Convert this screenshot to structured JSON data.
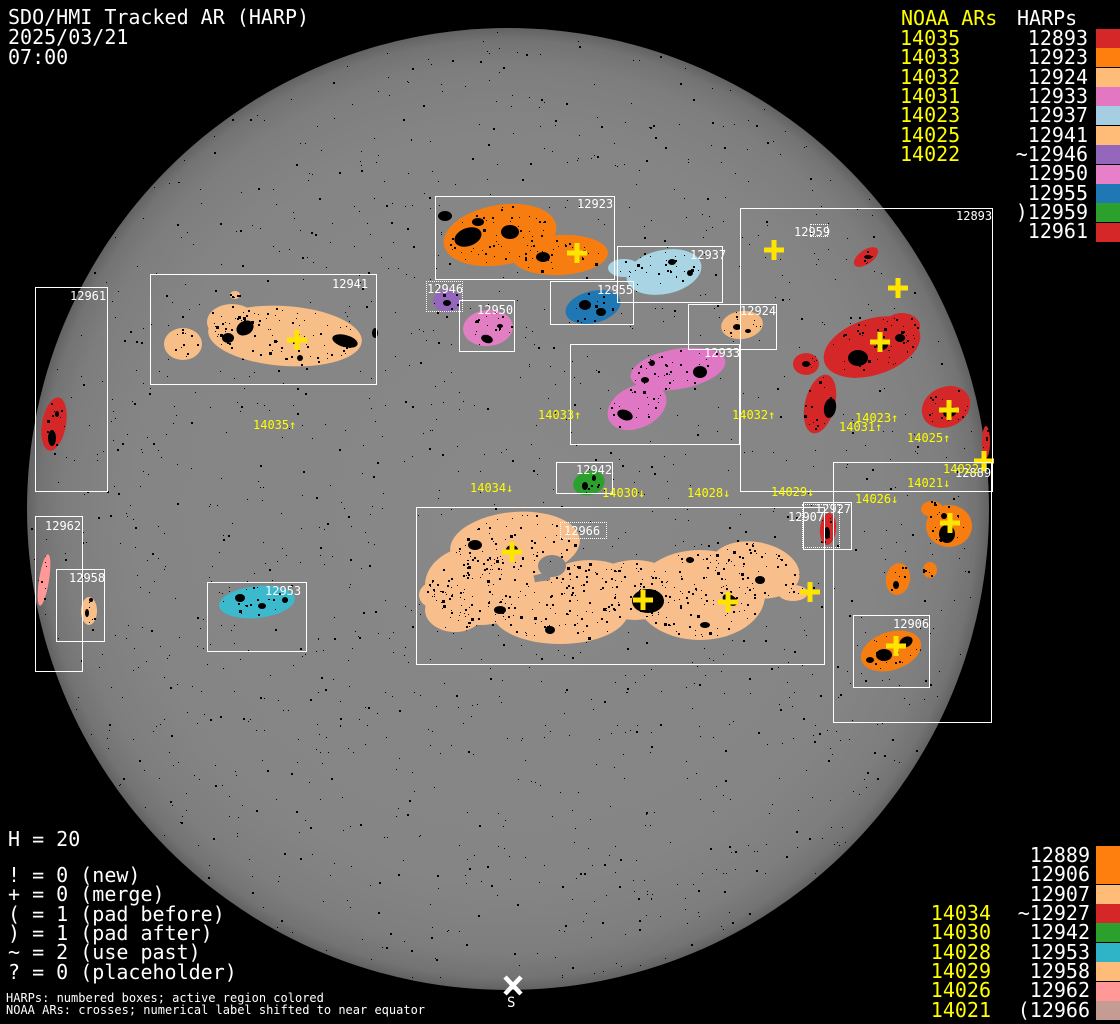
{
  "title": {
    "line1": "SDO/HMI Tracked AR (HARP)",
    "line2": "2025/03/21",
    "line3": "07:00"
  },
  "colors": {
    "background": "#000000",
    "disk_gray": "#858585",
    "box_line": "#ffffff",
    "harp_text": "#ffffff",
    "noaa_text": "#ffff00",
    "cross": "#ffe400",
    "speckle": "#000000",
    "south_marker": "#ffffff"
  },
  "top_legend": {
    "noaa_header": "NOAA ARs",
    "harp_header": "HARPs",
    "noaa_rows": [
      "14035",
      "14033",
      "14032",
      "14031",
      "14023",
      "14025",
      "14022"
    ],
    "harp_rows": [
      {
        "label": "12893",
        "swatch": "#d62728"
      },
      {
        "label": "12923",
        "swatch": "#ff7f0e"
      },
      {
        "label": "12924",
        "swatch": "#ffbb78"
      },
      {
        "label": "12933",
        "swatch": "#e377c2"
      },
      {
        "label": "12937",
        "swatch": "#a6cee3"
      },
      {
        "label": "12941",
        "swatch": "#ffbb78"
      },
      {
        "label": "~12946",
        "swatch": "#9467bd"
      },
      {
        "label": "12950",
        "swatch": "#e87fc9"
      },
      {
        "label": "12955",
        "swatch": "#1f77b4"
      },
      {
        "label": ")12959",
        "swatch": "#2ca02c"
      },
      {
        "label": "12961",
        "swatch": "#d62728"
      }
    ]
  },
  "bottom_legend": {
    "noaa_rows": [
      "14034",
      "14030",
      "14028",
      "14029",
      "14026",
      "14021"
    ],
    "harp_rows": [
      {
        "label": "12889",
        "swatch": "#ff7f0e"
      },
      {
        "label": "12906",
        "swatch": "#ff7f0e"
      },
      {
        "label": "12907",
        "swatch": "#ffbb78"
      },
      {
        "label": "~12927",
        "swatch": "#d62728"
      },
      {
        "label": "12942",
        "swatch": "#2ca02c"
      },
      {
        "label": "12953",
        "swatch": "#2fb3c7"
      },
      {
        "label": "12958",
        "swatch": "#ffbb78"
      },
      {
        "label": "12962",
        "swatch": "#ff9896"
      },
      {
        "label": "(12966",
        "swatch": "#c49c94"
      }
    ]
  },
  "stats": {
    "harp_count": "H = 20",
    "flags": [
      "! = 0 (new)",
      "+ = 0 (merge)",
      "( = 1 (pad before)",
      ") = 1 (pad after)",
      "~ = 2 (use past)",
      "? = 0 (placeholder)"
    ]
  },
  "footnotes": {
    "line1": "HARPs: numbered boxes; active region colored",
    "line2": "NOAA ARs: crosses; numerical label shifted to near equator"
  },
  "disk": {
    "south_marker": "S"
  },
  "regions": {
    "12889": {
      "label": "12889",
      "color": "#f87d10"
    },
    "12893": {
      "label": "12893",
      "color": "#d62728"
    },
    "12906": {
      "label": "12906",
      "color": "#f87d10"
    },
    "12907": {
      "label": "12907",
      "color": "#ffbb78"
    },
    "12923": {
      "label": "12923",
      "color": "#f87d10"
    },
    "12924": {
      "label": "12924",
      "color": "#f5b97f"
    },
    "12927": {
      "label": "12927",
      "color": "#d62728"
    },
    "12933": {
      "label": "12933",
      "color": "#df77c4"
    },
    "12937": {
      "label": "12937",
      "color": "#a8d4e4"
    },
    "12941": {
      "label": "12941",
      "color": "#f8be88"
    },
    "12942": {
      "label": "12942",
      "color": "#2ca02c"
    },
    "12946": {
      "label": "12946",
      "color": "#9467bd"
    },
    "12950": {
      "label": "12950",
      "color": "#e27fc3"
    },
    "12953": {
      "label": "12953",
      "color": "#3cb9cd"
    },
    "12955": {
      "label": "12955",
      "color": "#1f77b4"
    },
    "12958": {
      "label": "12958",
      "color": "#f8be88"
    },
    "12959": {
      "label": "12959",
      "color": "#2ca02c"
    },
    "12961": {
      "label": "12961",
      "color": "#d62728"
    },
    "12962": {
      "label": "12962",
      "color": "#ff9896"
    },
    "12966": {
      "label": "12966",
      "color": "#f8be8c"
    }
  },
  "noaa_disk_labels": [
    {
      "text": "14035↑"
    },
    {
      "text": "14033↑"
    },
    {
      "text": "14032↑"
    },
    {
      "text": "14031↑"
    },
    {
      "text": "14023↑"
    },
    {
      "text": "14025↑"
    },
    {
      "text": "14022↑"
    },
    {
      "text": "14034↓"
    },
    {
      "text": "14030↓"
    },
    {
      "text": "14028↓"
    },
    {
      "text": "14029↓"
    },
    {
      "text": "14026↓"
    },
    {
      "text": "14021↓"
    }
  ],
  "chart_data": {
    "type": "table",
    "title": "SDO/HMI Tracked AR (HARP) 2025/03/21 07:00",
    "columns": [
      "NOAA AR",
      "HARP"
    ],
    "rows": [
      [
        "14035",
        "12941"
      ],
      [
        "14033",
        "12933"
      ],
      [
        "14032",
        "12924"
      ],
      [
        "14031",
        "12893"
      ],
      [
        "14023",
        "12893"
      ],
      [
        "14025",
        "12893"
      ],
      [
        "14022",
        "12889"
      ],
      [
        "14034",
        "12966"
      ],
      [
        "14030",
        "12942"
      ],
      [
        "14028",
        "12966"
      ],
      [
        "14029",
        "12927"
      ],
      [
        "14026",
        "12906"
      ],
      [
        "14021",
        "12889"
      ]
    ],
    "harp_count": 20,
    "flag_counts": {
      "new": 0,
      "merge": 0,
      "pad_before": 1,
      "pad_after": 1,
      "use_past": 2,
      "placeholder": 0
    }
  }
}
